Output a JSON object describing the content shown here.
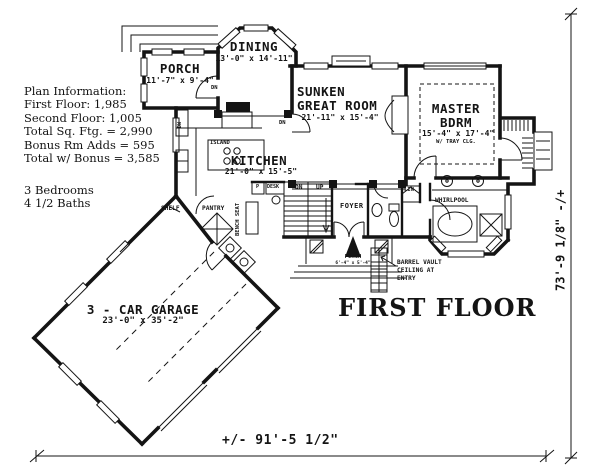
{
  "plan_info": {
    "lines": [
      "Plan Information:",
      "First Floor: 1,985",
      "Second Floor: 1,005",
      "Total Sq. Ftg. = 2,990",
      "Bonus Rm Adds = 595",
      "Total w/ Bonus = 3,585"
    ],
    "bedrooms": "3 Bedrooms",
    "baths": "4 1/2 Baths"
  },
  "rooms": {
    "porch_nw": {
      "name": "PORCH",
      "dims": "11'-7\" x 9'-4\""
    },
    "dining": {
      "name": "DINING",
      "dims": "13'-0\" x 14'-11\""
    },
    "great_room": {
      "line1": "SUNKEN",
      "line2": "GREAT ROOM",
      "dims": "21'-11\" x 15'-4\""
    },
    "master": {
      "line1": "MASTER",
      "line2": "BDRM",
      "dims": "15'-4\" x 17'-4\"",
      "note": "W/ TRAY CLG."
    },
    "kitchen": {
      "name": "KITCHEN",
      "dims": "21'-0\" x 15'-5\""
    },
    "garage": {
      "name": "3 - CAR GARAGE",
      "dims": "23'-0\" x 35'-2\""
    },
    "foyer": {
      "name": "FOYER"
    },
    "entry_porch": {
      "name": "PORCH",
      "dims": "6'-4\" x 5'-4\""
    }
  },
  "labels": {
    "island": "ISLAND",
    "pantry": "PANTRY",
    "shelf": "SHELF",
    "bench_seat": "BENCH SEAT",
    "desk": "DESK",
    "p": "P",
    "dn": "DN",
    "up": "UP",
    "lin": "LIN.",
    "whirlpool": "WHIRLPOOL",
    "dw": "DW",
    "barrel_line1": "BARREL VAULT",
    "barrel_line2": "CEILING AT",
    "barrel_line3": "ENTRY"
  },
  "annotations": {
    "floor_title": "FIRST FLOOR",
    "width_dim": "+/- 91'-5 1/2\"",
    "height_dim": "73'-9 1/8\" -/+"
  },
  "colors": {
    "ink": "#141414",
    "paper": "#ffffff"
  }
}
